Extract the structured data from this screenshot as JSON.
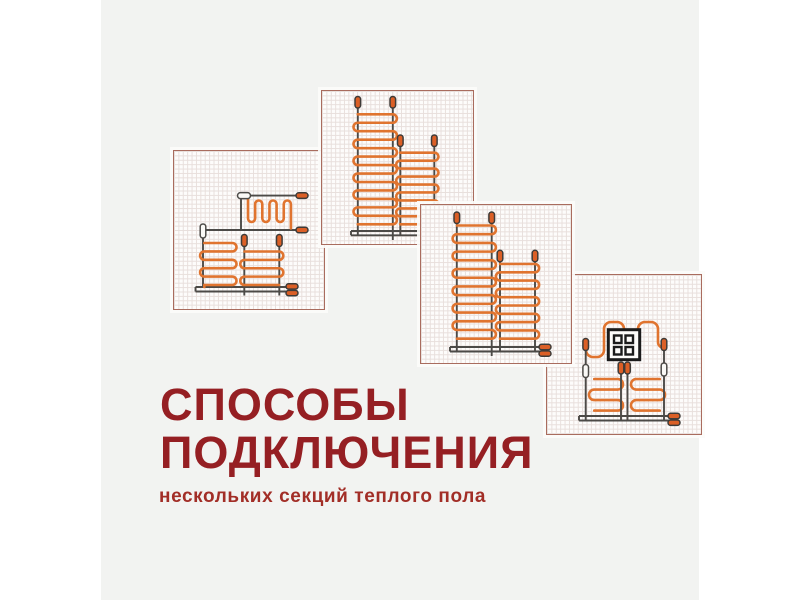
{
  "title": {
    "line1": "СПОСОБЫ",
    "line2": "ПОДКЛЮЧЕНИЯ",
    "color": "#951f23"
  },
  "subtitle": {
    "text": "нескольких секций теплого пола",
    "color": "#a22e27"
  },
  "background": {
    "page_letterbox": "#ffffff",
    "content": "#f2f3f1",
    "panel": "#fdfcfb",
    "panel_border": "#a96c5e",
    "grid_line": "#e8dfdc"
  },
  "diagram_colors": {
    "heating_cable_orange": "#e0742f",
    "cold_lead_gray": "#4c4a47",
    "end_cap_fill": "#db5f26",
    "coupler_fill": "#faf9f6",
    "junction_box_black": "#1b1b1b"
  },
  "panels": [
    {
      "name": "scheme-1-stepped-combined-sections",
      "description": "two heating sections with couplers and stepped serpentine on grid paper"
    },
    {
      "name": "scheme-2-two-parallel-sections",
      "description": "tall and short serpentine sections joined to one bottom power lead"
    },
    {
      "name": "scheme-3-two-parallel-sections-with-end-caps",
      "description": "tall and short serpentine sections, power lead ends with two cable end caps"
    },
    {
      "name": "scheme-4-sections-around-junction-box",
      "description": "crown serpentine around junction box plus two lower serpentine sections"
    }
  ],
  "icons": {
    "end-cap-icon": "orange capsule (cable end seal)",
    "coupler-icon": "white capsule (cable splice)",
    "junction-box-icon": "black square with four windows",
    "power-bus-icon": "double horizontal lead line"
  }
}
